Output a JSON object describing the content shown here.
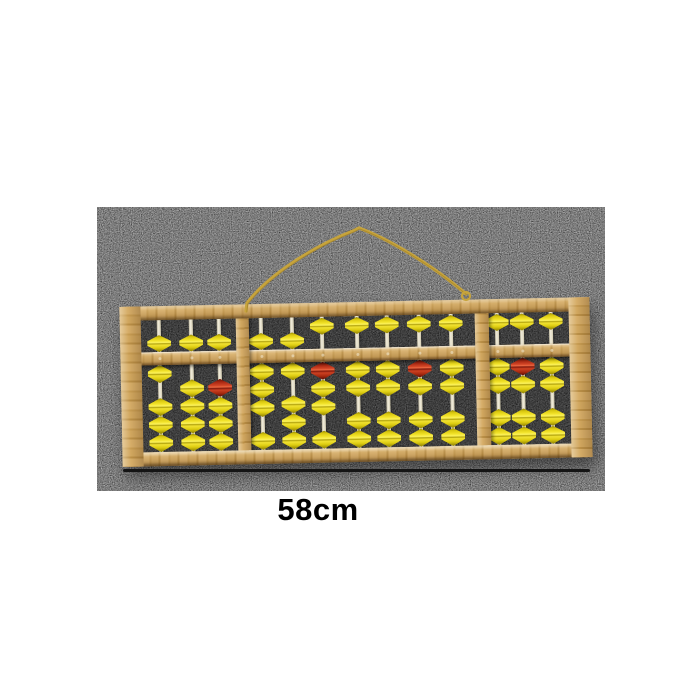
{
  "caption": {
    "size_label": "58cm"
  },
  "colors": {
    "carpet_gray": "#868686",
    "interior_dark": "#3a3a3a",
    "wood_tan": "#cfa55f",
    "rod_ivory": "#e9e2c8",
    "bead_yellow": "#eedd15",
    "bead_red": "#b93019",
    "string_gold": "#c7a43c",
    "annotation_black": "#141414"
  },
  "abacus": {
    "rod_count": 13,
    "upper_beads_per_rod": 1,
    "lower_beads_per_rod": 4,
    "groups": [
      3,
      7,
      3
    ],
    "red_bead_rods": [
      3,
      6,
      9,
      12
    ],
    "rods": [
      {
        "n": 1,
        "upper": "down",
        "lower_up": 1,
        "red_top": false
      },
      {
        "n": 2,
        "upper": "down",
        "lower_up": 0,
        "red_top": false
      },
      {
        "n": 3,
        "upper": "down",
        "lower_up": 0,
        "red_top": true
      },
      {
        "n": 4,
        "upper": "down",
        "lower_up": 3,
        "red_top": false
      },
      {
        "n": 5,
        "upper": "down",
        "lower_up": 1,
        "red_top": false
      },
      {
        "n": 6,
        "upper": "up",
        "lower_up": 3,
        "red_top": true
      },
      {
        "n": 7,
        "upper": "up",
        "lower_up": 2,
        "red_top": false
      },
      {
        "n": 8,
        "upper": "up",
        "lower_up": 2,
        "red_top": false
      },
      {
        "n": 9,
        "upper": "up",
        "lower_up": 2,
        "red_top": true
      },
      {
        "n": 10,
        "upper": "up",
        "lower_up": 2,
        "red_top": false
      },
      {
        "n": 11,
        "upper": "up",
        "lower_up": 2,
        "red_top": false
      },
      {
        "n": 12,
        "upper": "up",
        "lower_up": 2,
        "red_top": true
      },
      {
        "n": 13,
        "upper": "up",
        "lower_up": 2,
        "red_top": false
      }
    ]
  }
}
